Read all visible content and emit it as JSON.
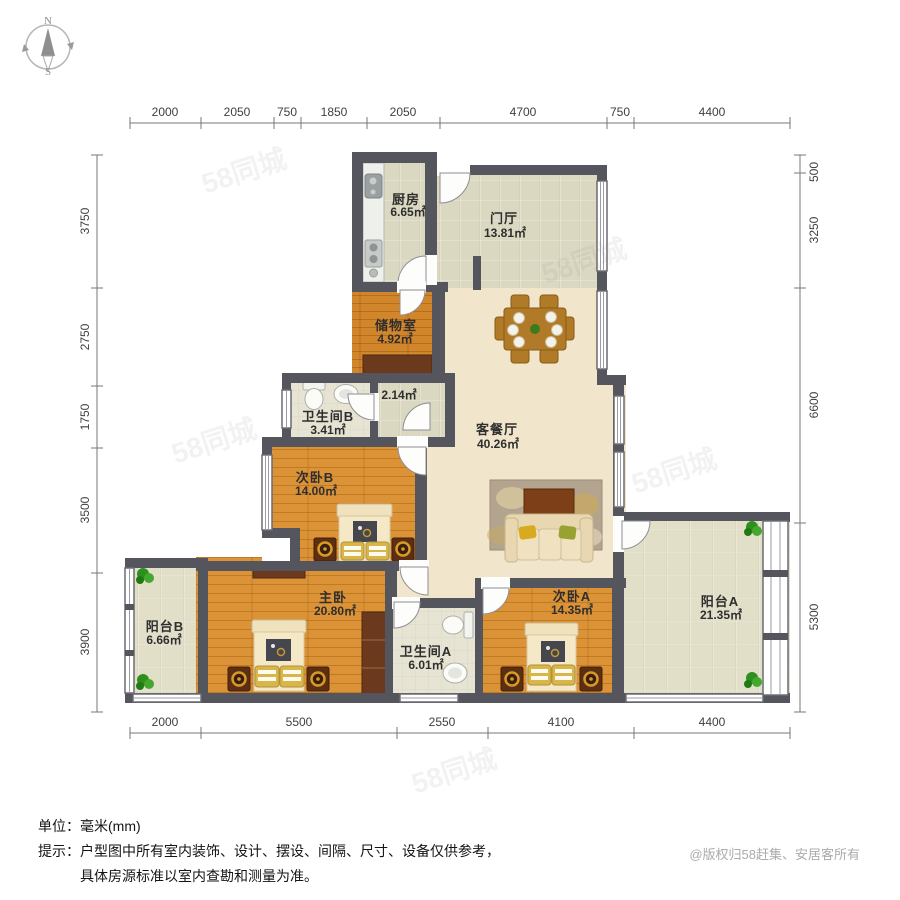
{
  "compass": {
    "north": "N",
    "south": "S"
  },
  "dims": {
    "top": [
      "2000",
      "2050",
      "750",
      "1850",
      "2050",
      "4700",
      "750",
      "4400"
    ],
    "bottom": [
      "2000",
      "5500",
      "2550",
      "4100",
      "4400"
    ],
    "left": [
      "3750",
      "2750",
      "1750",
      "3500",
      "3900"
    ],
    "right": [
      "500",
      "3250",
      "6600",
      "5300"
    ]
  },
  "rooms": {
    "kitchen": {
      "name": "厨房",
      "area": "6.65㎡"
    },
    "foyer": {
      "name": "门厅",
      "area": "13.81㎡"
    },
    "storage": {
      "name": "储物室",
      "area": "4.92㎡"
    },
    "bathroom_b": {
      "name": "卫生间B",
      "area": "3.41㎡"
    },
    "corridor": {
      "area": "2.14㎡"
    },
    "living": {
      "name": "客餐厅",
      "area": "40.26㎡"
    },
    "bedroom_b": {
      "name": "次卧B",
      "area": "14.00㎡"
    },
    "balcony_b": {
      "name": "阳台B",
      "area": "6.66㎡"
    },
    "master": {
      "name": "主卧",
      "area": "20.80㎡"
    },
    "bathroom_a": {
      "name": "卫生间A",
      "area": "6.01㎡"
    },
    "bedroom_a": {
      "name": "次卧A",
      "area": "14.35㎡"
    },
    "balcony_a": {
      "name": "阳台A",
      "area": "21.35㎡"
    }
  },
  "footer": {
    "unit_label": "单位：",
    "unit_value": "毫米(mm)",
    "tip_label": "提示：",
    "tip_line1": "户型图中所有室内装饰、设计、摆设、间隔、尺寸、设备仅供参考，",
    "tip_line2": "具体房源标准以室内查勘和测量为准。",
    "copyright": "@版权归58赶集、安居客所有"
  },
  "watermark": "58同城",
  "colors": {
    "wall": "#55555d",
    "wood_floor": "#dc9338",
    "dark_wood": "#6b3a1c",
    "tile": "#dbd8c2"
  }
}
